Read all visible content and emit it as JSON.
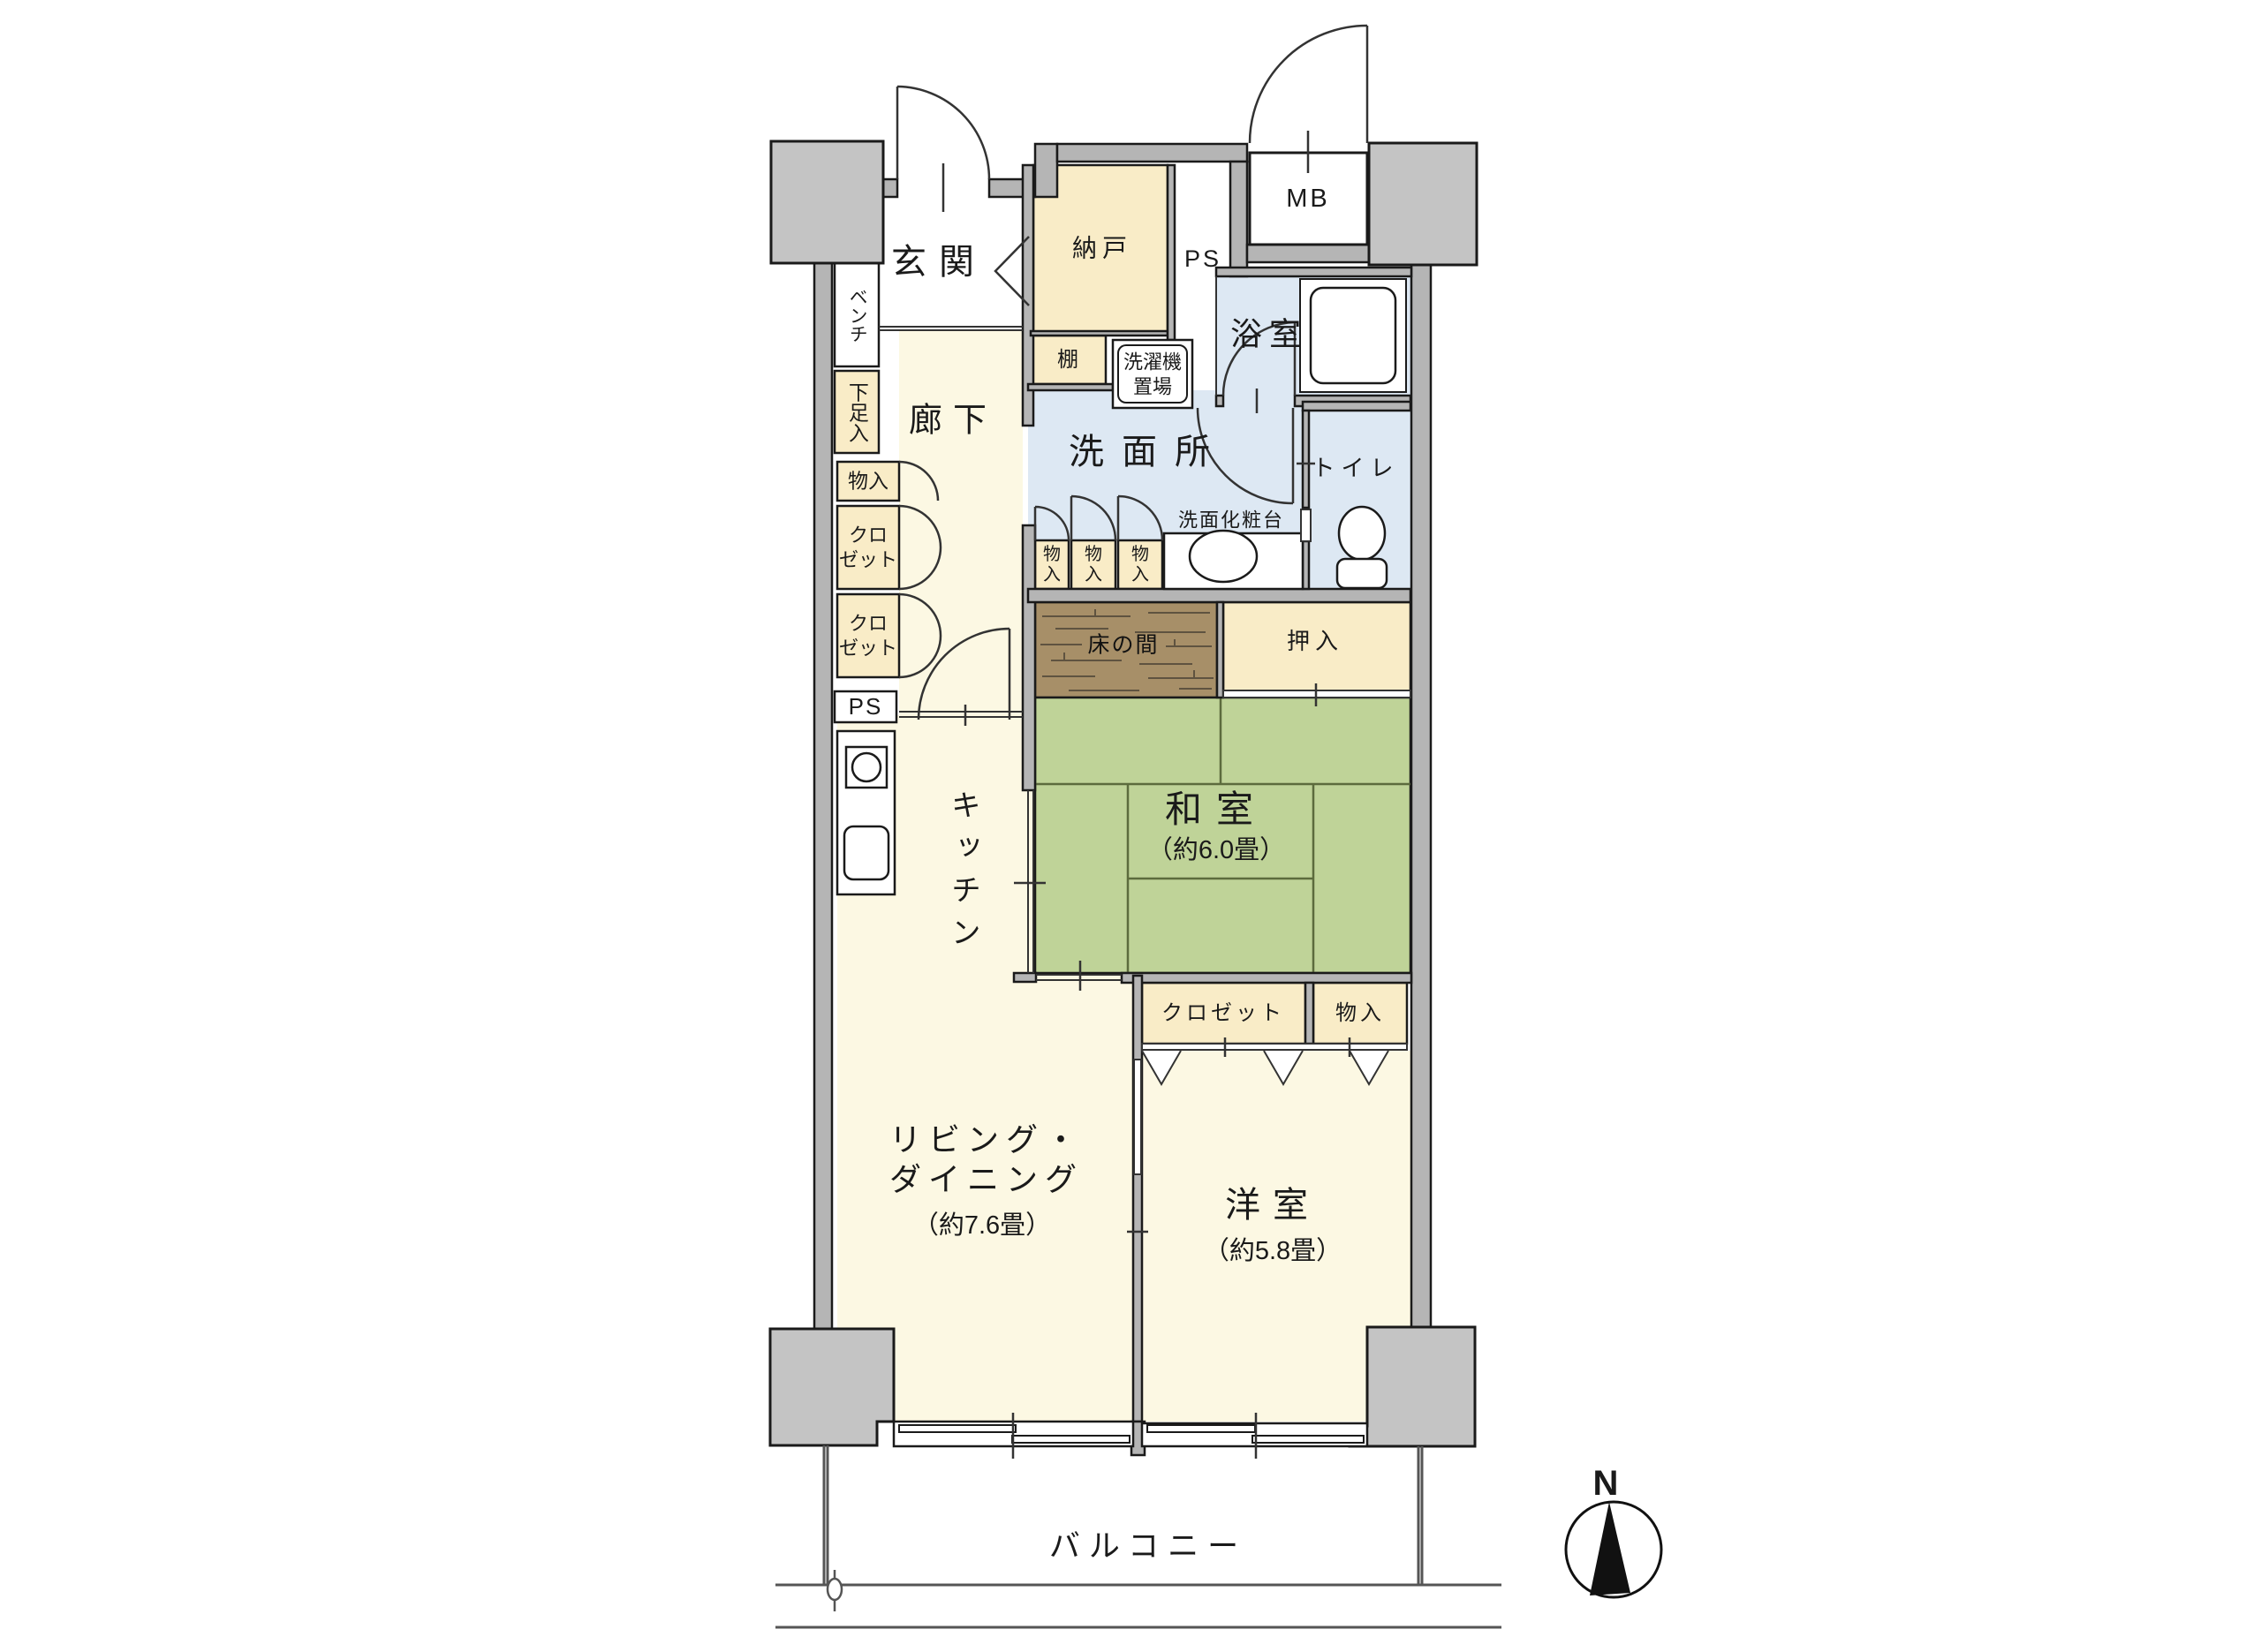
{
  "palette": {
    "wall": "#b5b5b5",
    "pillar": "#c4c4c4",
    "outline": "#1a1a1a",
    "floor_cream": "#fcf8e3",
    "closet_cream": "#f9ecc7",
    "wet_blue": "#dde8f3",
    "tatami_green": "#bfd398",
    "tokonoma_brown": "#a78f68"
  },
  "rooms": {
    "genkan": {
      "label": "玄関"
    },
    "nando": {
      "label": "納戸"
    },
    "tana": {
      "label": "棚"
    },
    "ps_top": {
      "label": "PS"
    },
    "mb": {
      "label": "MB"
    },
    "bathroom": {
      "label": "浴室"
    },
    "washer": {
      "label": "洗濯機\n置場"
    },
    "washroom": {
      "label": "洗面所"
    },
    "vanity": {
      "label": "洗面化粧台"
    },
    "toilet": {
      "label": "トイレ"
    },
    "hallway": {
      "label": "廊下"
    },
    "bench": {
      "label": "ベンチ"
    },
    "shoe_box": {
      "label": "下足入"
    },
    "hall_storage": {
      "label": "物入"
    },
    "hall_closet_1": {
      "label": "クロ\nゼット"
    },
    "hall_closet_2": {
      "label": "クロ\nゼット"
    },
    "ps_left": {
      "label": "PS"
    },
    "kitchen": {
      "label": "キッチン"
    },
    "storage_1": {
      "label": "物\n入"
    },
    "storage_2": {
      "label": "物\n入"
    },
    "storage_3": {
      "label": "物\n入"
    },
    "tokonoma": {
      "label": "床の間"
    },
    "oshiire": {
      "label": "押入"
    },
    "washitsu": {
      "label": "和室",
      "size": "（約6.0畳）"
    },
    "closet_west": {
      "label": "クロゼット"
    },
    "storage_west": {
      "label": "物入"
    },
    "living": {
      "label": "リビング・\nダイニング",
      "size": "（約7.6畳）"
    },
    "youshitsu": {
      "label": "洋室",
      "size": "（約5.8畳）"
    },
    "balcony": {
      "label": "バルコニー"
    },
    "compass": {
      "label": "N"
    }
  }
}
